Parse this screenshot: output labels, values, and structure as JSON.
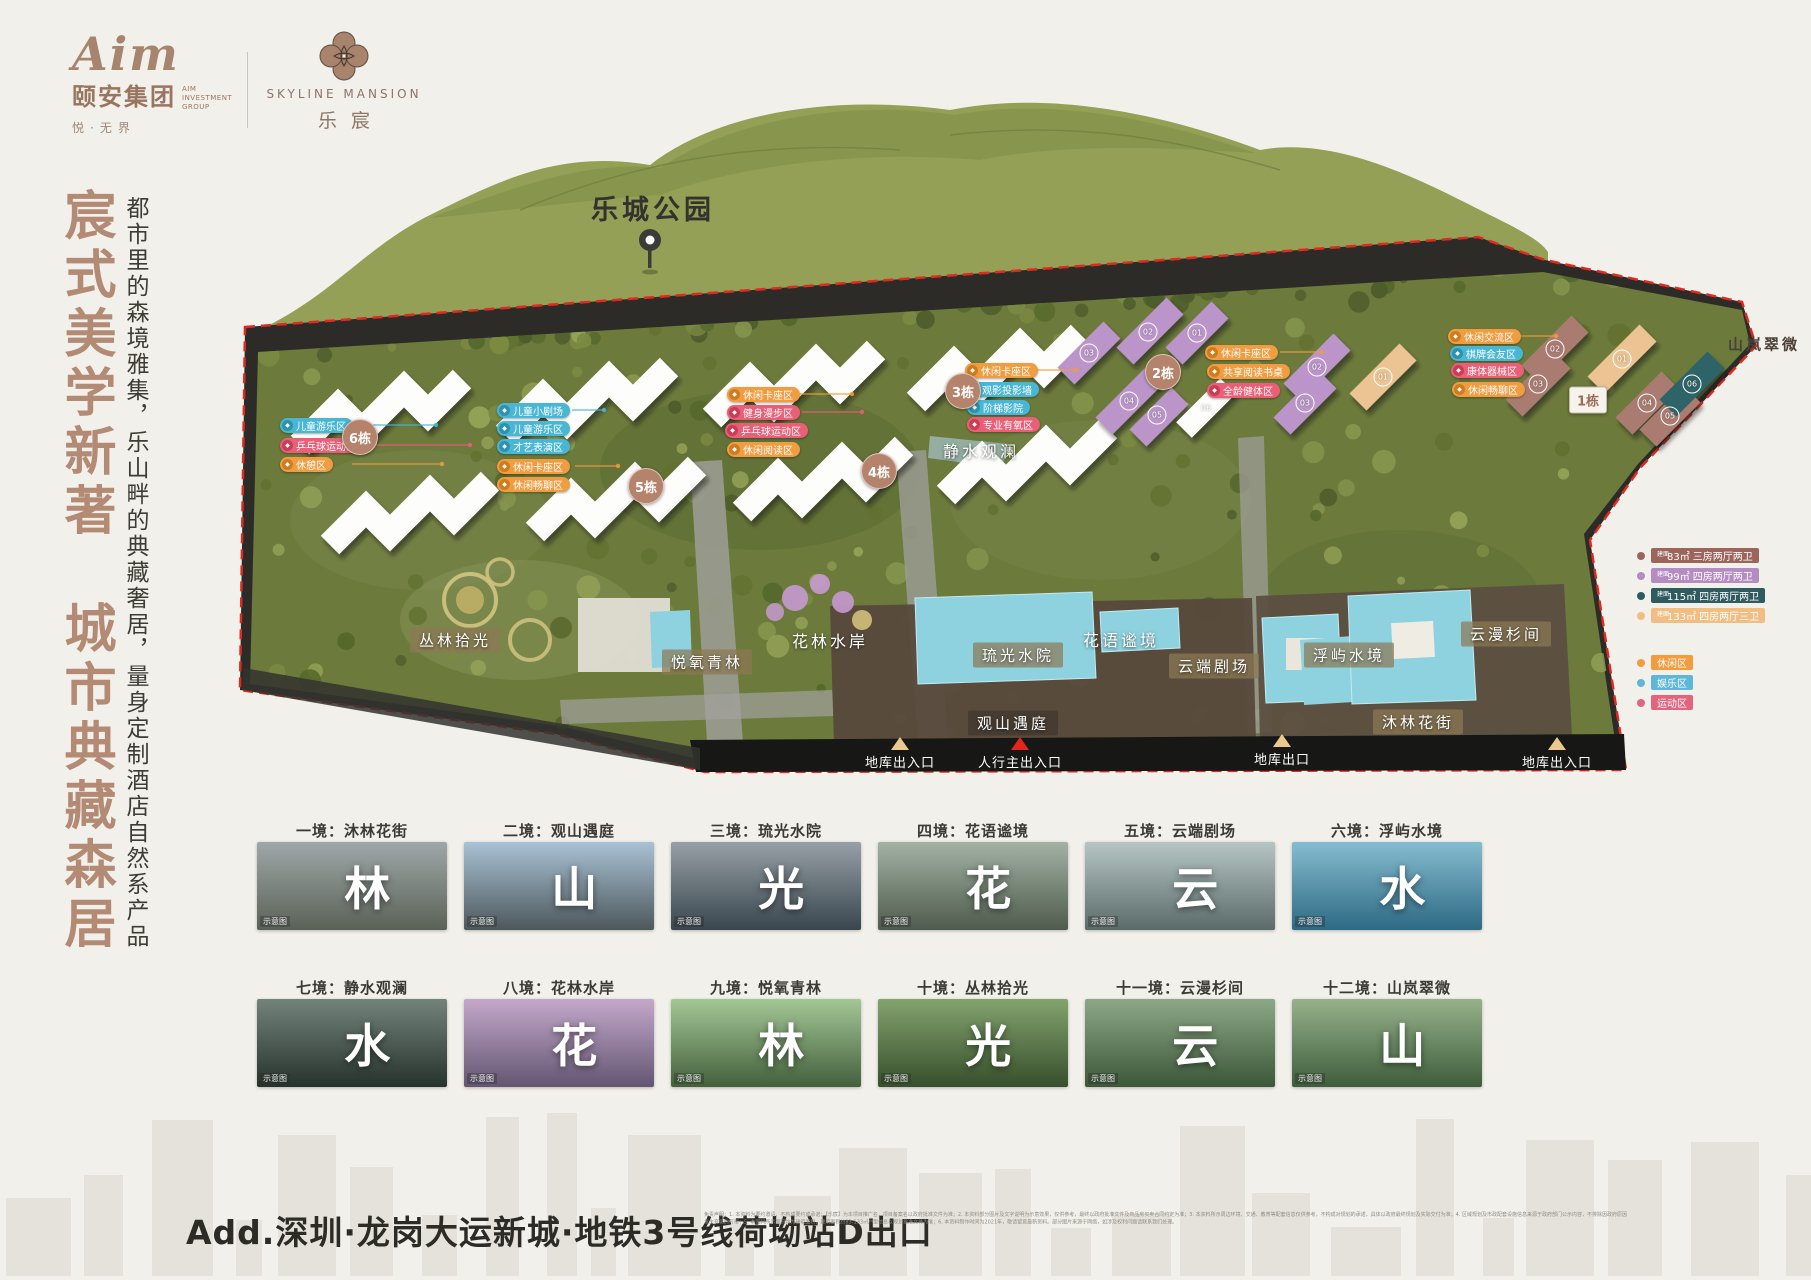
{
  "header": {
    "brand_script": "Aim",
    "brand_name": "颐安集团",
    "brand_sub": "AIM INVESTMENT GROUP",
    "brand_slogan": "悦·无界",
    "project_en": "SKYLINE MANSION",
    "project_cn": "乐宸"
  },
  "left_panel": {
    "headline": "宸式美学新著　城市典藏森居",
    "subline": "都市里的森境雅集，乐山畔的典藏奢居，量身定制酒店自然系产品"
  },
  "park": {
    "label": "乐城公园"
  },
  "plan": {
    "area_labels": [
      {
        "text": "丛林拾光",
        "x": 455,
        "y": 640,
        "variant": "tan"
      },
      {
        "text": "悦氧青林",
        "x": 707,
        "y": 662,
        "variant": "tan"
      },
      {
        "text": "花林水岸",
        "x": 830,
        "y": 640,
        "variant": "plain"
      },
      {
        "text": "静水观澜",
        "x": 981,
        "y": 450,
        "variant": "plain"
      },
      {
        "text": "琉光水院",
        "x": 1018,
        "y": 655,
        "variant": "tan"
      },
      {
        "text": "花语谧境",
        "x": 1121,
        "y": 639,
        "variant": "plain"
      },
      {
        "text": "云端剧场",
        "x": 1214,
        "y": 666,
        "variant": "tan"
      },
      {
        "text": "观山遇庭",
        "x": 1013,
        "y": 723,
        "variant": "dark-tan"
      },
      {
        "text": "浮屿水境",
        "x": 1349,
        "y": 655,
        "variant": "tan"
      },
      {
        "text": "云漫杉间",
        "x": 1506,
        "y": 634,
        "variant": "tan"
      },
      {
        "text": "沐林花街",
        "x": 1418,
        "y": 722,
        "variant": "tan"
      },
      {
        "text": "山岚翠微",
        "x": 1764,
        "y": 344,
        "variant": "dark"
      }
    ],
    "badges": [
      {
        "text": "6栋",
        "x": 360,
        "y": 437,
        "variant": "circle"
      },
      {
        "text": "5栋",
        "x": 646,
        "y": 486,
        "variant": "circle"
      },
      {
        "text": "4栋",
        "x": 879,
        "y": 471,
        "variant": "circle"
      },
      {
        "text": "3栋",
        "x": 963,
        "y": 391,
        "variant": "circle"
      },
      {
        "text": "2栋",
        "x": 1163,
        "y": 372,
        "variant": "circle"
      },
      {
        "text": "1栋",
        "x": 1588,
        "y": 400,
        "variant": "square"
      }
    ],
    "units": [
      {
        "text": "02",
        "x": 1148,
        "y": 332
      },
      {
        "text": "01",
        "x": 1197,
        "y": 333
      },
      {
        "text": "03",
        "x": 1089,
        "y": 353
      },
      {
        "text": "04",
        "x": 1129,
        "y": 401
      },
      {
        "text": "05",
        "x": 1157,
        "y": 415
      },
      {
        "text": "06",
        "x": 1206,
        "y": 408
      },
      {
        "text": "02",
        "x": 1317,
        "y": 367
      },
      {
        "text": "03",
        "x": 1305,
        "y": 403
      },
      {
        "text": "01",
        "x": 1383,
        "y": 377
      },
      {
        "text": "02",
        "x": 1555,
        "y": 349
      },
      {
        "text": "03",
        "x": 1538,
        "y": 384
      },
      {
        "text": "01",
        "x": 1622,
        "y": 359
      },
      {
        "text": "04",
        "x": 1647,
        "y": 403
      },
      {
        "text": "05",
        "x": 1670,
        "y": 416
      },
      {
        "text": "06",
        "x": 1692,
        "y": 384
      }
    ],
    "pills": [
      {
        "text": "儿童游乐区",
        "color": "cyan",
        "x": 280,
        "y": 418
      },
      {
        "text": "乒乓球运动区",
        "color": "pink",
        "x": 280,
        "y": 438
      },
      {
        "text": "休憩区",
        "color": "orange",
        "x": 280,
        "y": 457
      },
      {
        "text": "儿童小剧场",
        "color": "cyan",
        "x": 497,
        "y": 403
      },
      {
        "text": "儿童游乐区",
        "color": "cyan",
        "x": 497,
        "y": 421
      },
      {
        "text": "才艺表演区",
        "color": "cyan",
        "x": 497,
        "y": 439
      },
      {
        "text": "休闲卡座区",
        "color": "orange",
        "x": 497,
        "y": 459
      },
      {
        "text": "休闲畅聊区",
        "color": "orange",
        "x": 497,
        "y": 477
      },
      {
        "text": "休闲卡座区",
        "color": "orange",
        "x": 727,
        "y": 387
      },
      {
        "text": "健身漫步区",
        "color": "pink",
        "x": 727,
        "y": 405
      },
      {
        "text": "乒乓球运动区",
        "color": "pink",
        "x": 725,
        "y": 423
      },
      {
        "text": "休闲阅读区",
        "color": "orange",
        "x": 727,
        "y": 442
      },
      {
        "text": "休闲卡座区",
        "color": "orange",
        "x": 965,
        "y": 363
      },
      {
        "text": "观影投影墙",
        "color": "cyan",
        "x": 966,
        "y": 382
      },
      {
        "text": "阶梯影院",
        "color": "cyan",
        "x": 967,
        "y": 400
      },
      {
        "text": "专业有氧区",
        "color": "pink",
        "x": 967,
        "y": 417
      },
      {
        "text": "休闲卡座区",
        "color": "orange",
        "x": 1205,
        "y": 345
      },
      {
        "text": "共享阅读书桌",
        "color": "orange",
        "x": 1207,
        "y": 364
      },
      {
        "text": "全龄健体区",
        "color": "pink",
        "x": 1207,
        "y": 383
      },
      {
        "text": "休闲交流区",
        "color": "orange",
        "x": 1448,
        "y": 329
      },
      {
        "text": "棋牌会友区",
        "color": "cyan",
        "x": 1450,
        "y": 346
      },
      {
        "text": "康体器械区",
        "color": "pink",
        "x": 1451,
        "y": 363
      },
      {
        "text": "休闲畅聊区",
        "color": "orange",
        "x": 1452,
        "y": 382
      }
    ],
    "entrances": [
      {
        "text": "地库出入口",
        "tri": "tan",
        "x": 900,
        "y": 737
      },
      {
        "text": "人行主出入口",
        "tri": "red",
        "x": 1020,
        "y": 737
      },
      {
        "text": "地库出口",
        "tri": "tan",
        "x": 1282,
        "y": 734
      },
      {
        "text": "地库出入口",
        "tri": "tan",
        "x": 1557,
        "y": 737
      }
    ]
  },
  "legend": {
    "units": [
      {
        "prefix": "建面",
        "area": "83㎡",
        "desc": "三房两厅两卫",
        "color": "#9c655c"
      },
      {
        "prefix": "建面",
        "area": "99㎡",
        "desc": "四房两厅两卫",
        "color": "#b48cc2"
      },
      {
        "prefix": "建面",
        "area": "115㎡",
        "desc": "四房两厅两卫",
        "color": "#2e5a60"
      },
      {
        "prefix": "建面",
        "area": "133㎡",
        "desc": "四房两厅三卫",
        "color": "#f0bd82"
      }
    ],
    "zones": [
      {
        "label": "休闲区",
        "color": "#f29b3f"
      },
      {
        "label": "娱乐区",
        "color": "#5fb7d8"
      },
      {
        "label": "运动区",
        "color": "#e2647e"
      }
    ]
  },
  "cards": [
    {
      "title": "一境：沐林花街",
      "char": "林",
      "mark": "示意图",
      "sky": "#9fa8a8",
      "ground": "#5a6257"
    },
    {
      "title": "二境：观山遇庭",
      "char": "山",
      "mark": "示意图",
      "sky": "#a9c2d4",
      "ground": "#4d585c"
    },
    {
      "title": "三境：琉光水院",
      "char": "光",
      "mark": "示意图",
      "sky": "#97a0a6",
      "ground": "#39464e"
    },
    {
      "title": "四境：花语谧境",
      "char": "花",
      "mark": "示意图",
      "sky": "#a3b2a4",
      "ground": "#4e5b4d"
    },
    {
      "title": "五境：云端剧场",
      "char": "云",
      "mark": "示意图",
      "sky": "#b7c6c4",
      "ground": "#5a6b6a"
    },
    {
      "title": "六境：浮屿水境",
      "char": "水",
      "mark": "示意图",
      "sky": "#85bcd0",
      "ground": "#2e6a84"
    },
    {
      "title": "七境：静水观澜",
      "char": "水",
      "mark": "示意图",
      "sky": "#73837a",
      "ground": "#26332d"
    },
    {
      "title": "八境：花林水岸",
      "char": "花",
      "mark": "示意图",
      "sky": "#c4a8cb",
      "ground": "#635672"
    },
    {
      "title": "九境：悦氧青林",
      "char": "林",
      "mark": "示意图",
      "sky": "#a4c796",
      "ground": "#43603c"
    },
    {
      "title": "十境：丛林拾光",
      "char": "光",
      "mark": "示意图",
      "sky": "#83a36e",
      "ground": "#374f2c"
    },
    {
      "title": "十一境：云漫杉间",
      "char": "云",
      "mark": "示意图",
      "sky": "#8da887",
      "ground": "#3c5739"
    },
    {
      "title": "十二境：山岚翠微",
      "char": "山",
      "mark": "示意图",
      "sky": "#95b28b",
      "ground": "#3f5d3b"
    }
  ],
  "footer": {
    "address": "Add.深圳·龙岗大运新城·地铁3号线荷坳站D出口",
    "disclaimer": "免责声明：1. 本资料为要约邀请，不构成要约或承诺；【乐宸】为本项目推广名，项目备案名以政府批准文件为准；2. 本资料部分图片及文字说明为示意效果，仅供参考，最终以政府批准文件及商品房买卖合同约定为准；3. 本资料所示周边环境、交通、教育等配套信息仅供参考，不构成对规划的承诺，具体以政府最终规划及实际交付为准；4. 区域规划及市政配套设施信息来源于政府部门公示内容，不排除因政府原因发生变化的可能；5. 本资料所示面积均为建筑面积，建筑面积约83-133㎡户型信息以规划批准文件为准；6. 本资料制作时间为2021年，敬请留意最新资料。部分图片来源于网络，如涉及权利问题请联系我们处理。"
  }
}
